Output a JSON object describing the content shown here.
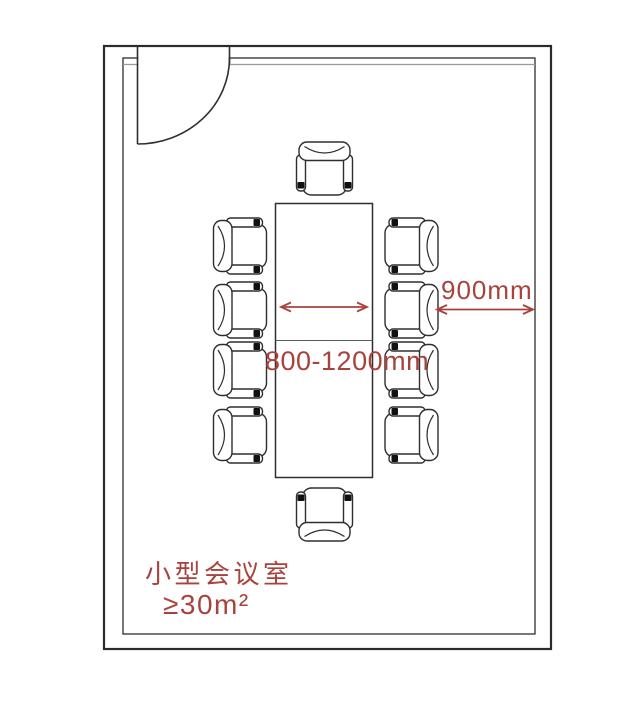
{
  "floor_plan": {
    "room": {
      "name_label": "小型会议室",
      "area_label": "≥30m²"
    },
    "annotations": {
      "aisle_width": "900mm",
      "table_width_range": "800-1200mm"
    },
    "furniture": {
      "table": "rectangular-conference-table",
      "chair_count": 10,
      "chair_layout": {
        "left": 4,
        "right": 4,
        "top": 1,
        "bottom": 1
      }
    },
    "door": {
      "position": "top-left",
      "type": "single-swing"
    },
    "colors": {
      "annotation_red": "#a8423d",
      "wall_line": "#2b2b2b",
      "background": "#ffffff"
    }
  }
}
